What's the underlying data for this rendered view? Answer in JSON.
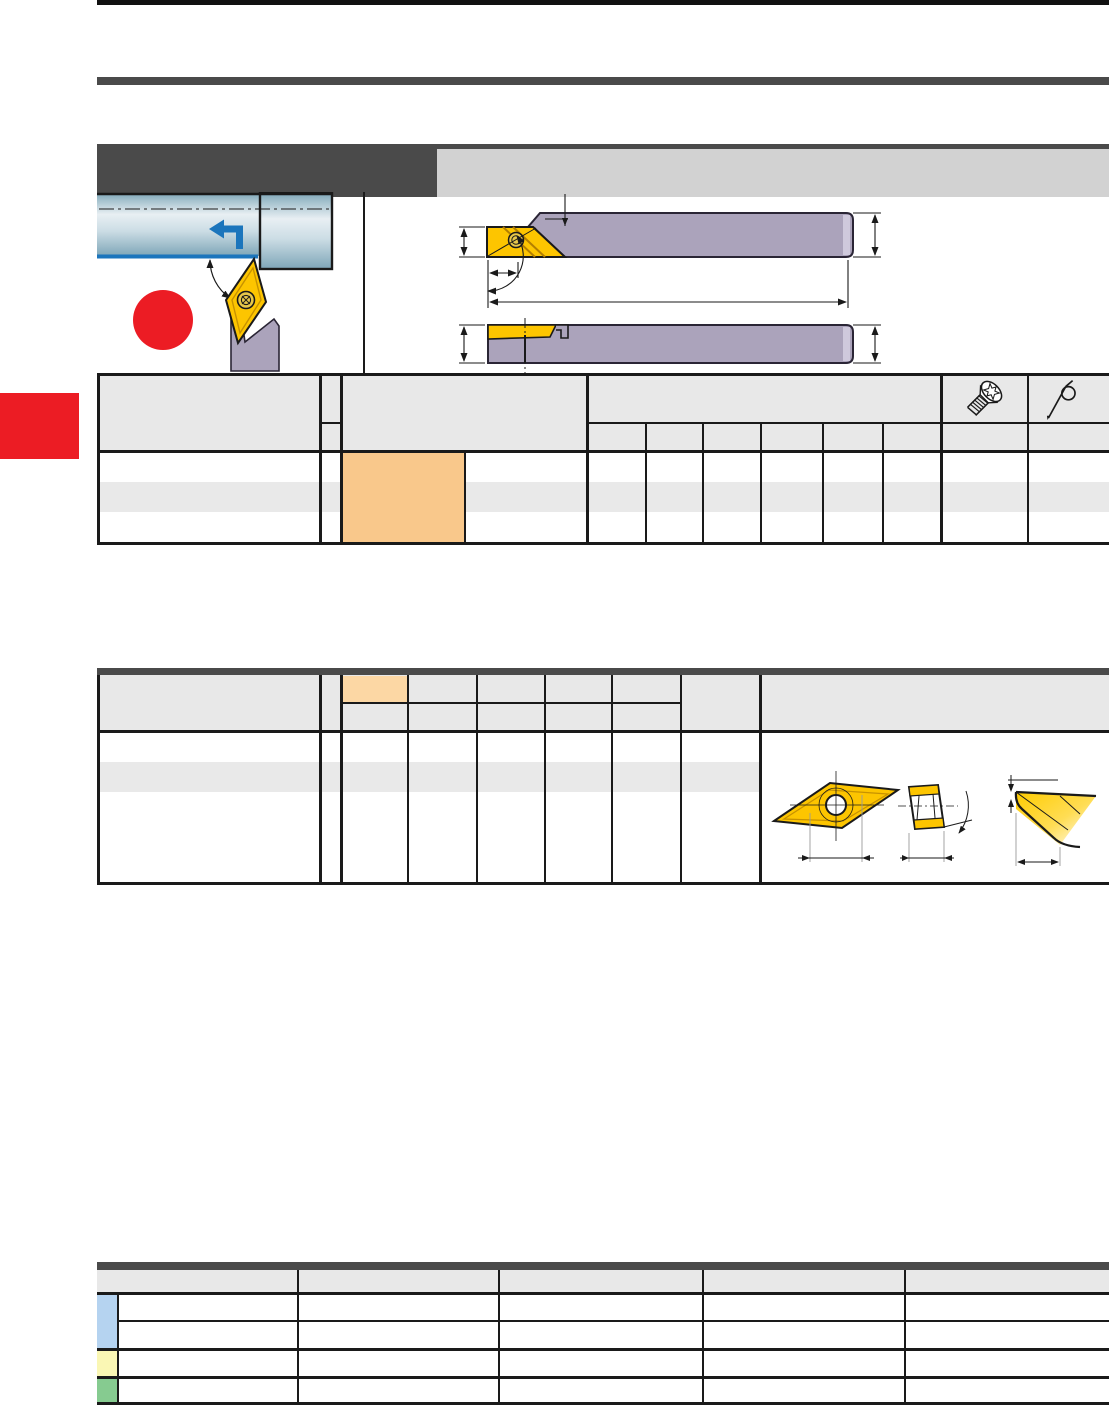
{
  "page": {
    "kind": "tool-catalog-page",
    "top_rule_color": "#111111",
    "section_bar_color": "#4a4a4a",
    "title_block_bg": "#4a4a4a",
    "subtitle_strip_bg": "#d2d2d2",
    "side_tab_color": "#ec1c24"
  },
  "application_figure": {
    "workpiece_gradient_top": "#86aebf",
    "workpiece_gradient_light": "#e8eff3",
    "feed_arrow_color": "#1b75bc",
    "machined_surface_color": "#1b75bc",
    "insert_color": "#fdc500",
    "holder_color": "#aba3bb",
    "marker_dot_color": "#ec1c24"
  },
  "holder_drawing": {
    "body_color": "#aba3bb",
    "end_face_color": "#cfc9dc",
    "insert_color": "#fdc500",
    "line_color": "#1a1a1a"
  },
  "holder_table": {
    "header_bg": "#e8e8e8",
    "row_alt_bg": "#e9e9e9",
    "highlight_cell_bg": "#f9c88b",
    "dimension_subcolumns": 6,
    "body_rows": 3,
    "spare_parts_icons": [
      "torx-screw-icon",
      "key-wrench-icon"
    ]
  },
  "insert_table": {
    "header_bg": "#e8e8e8",
    "row_alt_bg": "#e9e9e9",
    "highlight_cell_bg": "#fcd7a4",
    "dimension_subcolumns": 4,
    "views": [
      "insert-top-view",
      "insert-side-view",
      "insert-corner-detail"
    ]
  },
  "info_table": {
    "header_bg": "#e8e8e8",
    "columns": 5,
    "rows": 4,
    "marker_blue": "#b5d3f0",
    "marker_yellow": "#faf7b4",
    "marker_green": "#86cb90"
  }
}
